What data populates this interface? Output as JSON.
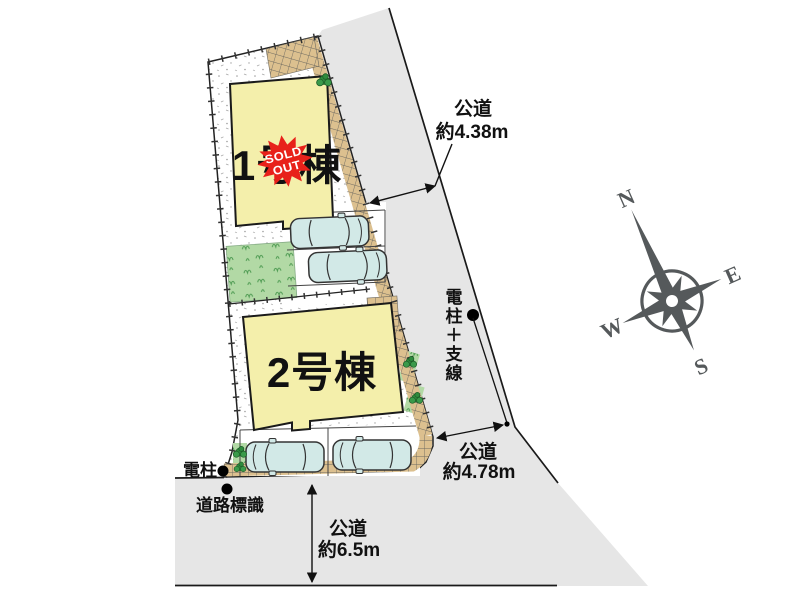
{
  "site_plan": {
    "buildings": [
      {
        "label": "1号棟",
        "badge": {
          "line1": "SOLD",
          "line2": "OUT"
        }
      },
      {
        "label": "2号棟"
      }
    ],
    "roads": {
      "north": {
        "name": "公道",
        "width": "約4.38m"
      },
      "east": {
        "name": "公道",
        "width": "約4.78m"
      },
      "south": {
        "name": "公道",
        "width": "約6.5m"
      }
    },
    "landmarks": {
      "utility_pole": "電柱",
      "road_sign": "道路標識",
      "pole_with_guy_wire": "電柱＋支線"
    },
    "compass": {
      "north": "N",
      "east": "E",
      "south": "S",
      "west": "W"
    },
    "colors": {
      "building": "#f4efab",
      "road": "#e6e6e6",
      "sold_badge": "#e8211a",
      "lawn": "#b2d9a5",
      "paving": "#dcc08f",
      "compass": "#55595b"
    }
  }
}
